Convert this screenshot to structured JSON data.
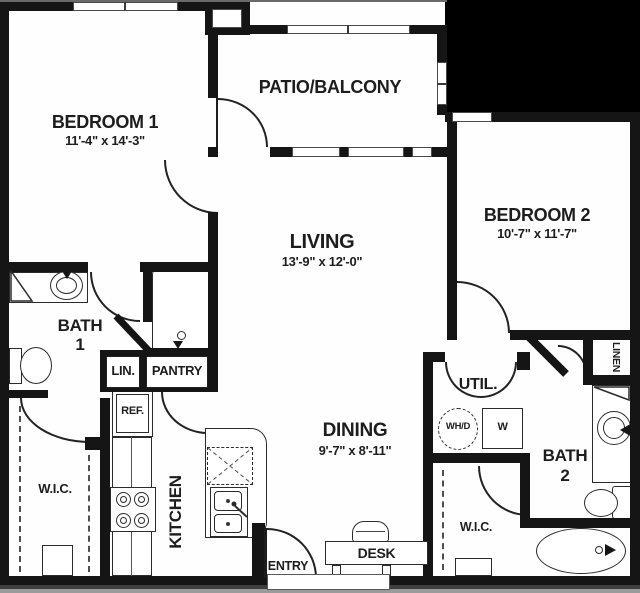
{
  "plan": {
    "bedroom1": {
      "name": "BEDROOM 1",
      "dims": "11'-4\" x 14'-3\""
    },
    "patio": {
      "name": "PATIO/BALCONY"
    },
    "bedroom2": {
      "name": "BEDROOM 2",
      "dims": "10'-7\" x 11'-7\""
    },
    "living": {
      "name": "LIVING",
      "dims": "13'-9\" x 12'-0\""
    },
    "dining": {
      "name": "DINING",
      "dims": "9'-7\" x 8'-11\""
    },
    "bath1": {
      "word": "BATH",
      "num": "1"
    },
    "bath2": {
      "word": "BATH",
      "num": "2"
    },
    "kitchen": {
      "name": "KITCHEN"
    },
    "entry": {
      "name": "ENTRY"
    },
    "util": {
      "name": "UTIL."
    },
    "desk": {
      "name": "DESK"
    },
    "linen": {
      "name": "LINEN"
    },
    "lin_closet": {
      "name": "LIN."
    },
    "pantry": {
      "name": "PANTRY"
    },
    "refrigerator": {
      "name": "REF."
    },
    "wic_left": {
      "name": "W.I.C."
    },
    "wic_right": {
      "name": "W.I.C."
    },
    "washer_dryer": {
      "name": "WH/D"
    },
    "washer": {
      "name": "W"
    }
  },
  "fixtures": [
    "bathtub",
    "garden-tub",
    "toilet",
    "vanity-sink",
    "round-sink",
    "stove-burners",
    "double-kitchen-sink",
    "upper-cabinet-dashed",
    "refrigerator",
    "desk-chair",
    "door-swing",
    "double-door-swing",
    "window",
    "closet-rod-dashed",
    "washer-box",
    "water-heater-dryer-circle",
    "linen-shelf",
    "entry-threshold"
  ],
  "colors": {
    "wall": "#151515",
    "background": "#ffffff",
    "outside_fill": "#000000",
    "line": "#2b2b2b"
  }
}
